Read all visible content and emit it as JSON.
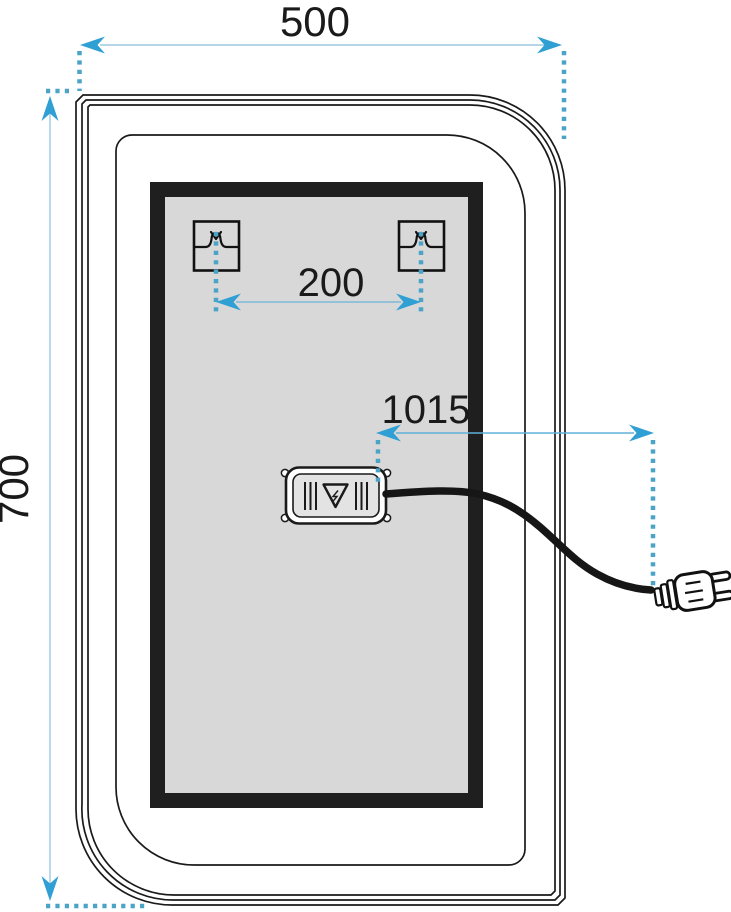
{
  "diagram": {
    "type": "technical-dimension-drawing",
    "subject": "LED mirror: front view with mounting brackets, control box and power plug",
    "labels": {
      "width": "500",
      "height": "700",
      "bracket_spacing": "200",
      "cable_length": "1015"
    },
    "colors": {
      "dimension_arrow": "#2f9fd4",
      "dimension_line": "#9cc9e0",
      "dotted_extension_line": "#4ba3c7",
      "outline": "#1a1a1a",
      "led_panel_fill": "#d8d8d8",
      "led_frame": "#1f1f1f",
      "background": "#ffffff"
    },
    "parts": [
      "mirror-body",
      "led-panel",
      "mounting-bracket-left",
      "mounting-bracket-right",
      "control-box",
      "power-cable",
      "power-plug"
    ]
  }
}
